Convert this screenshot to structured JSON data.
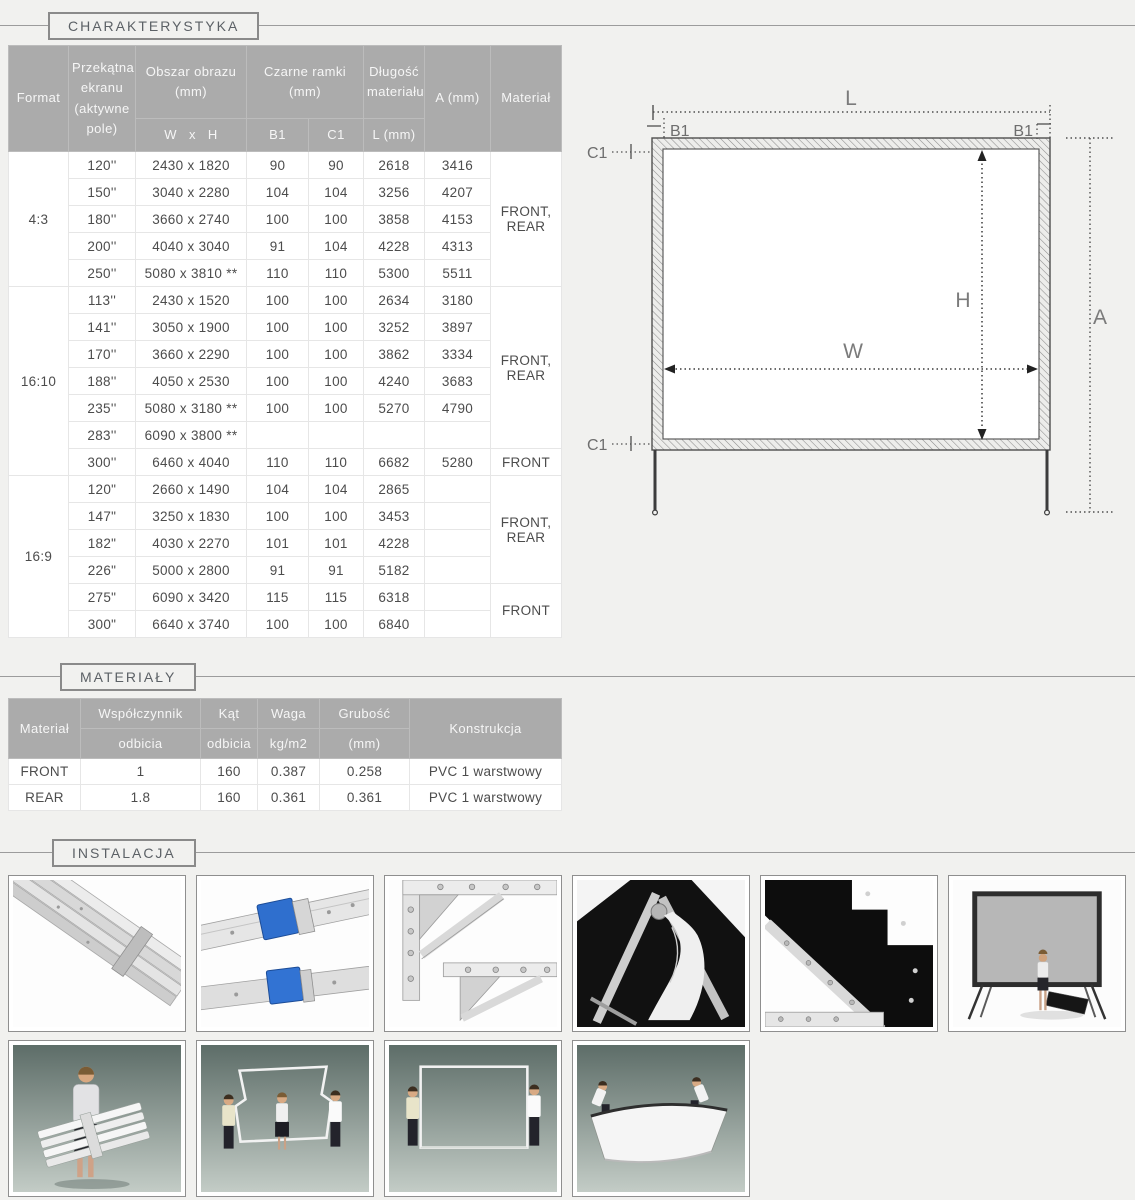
{
  "sections": {
    "charakterystyka": {
      "label": "CHARAKTERYSTYKA"
    },
    "materialy": {
      "label": "MATERIAŁY"
    },
    "instalacja": {
      "label": "INSTALACJA"
    }
  },
  "spec_table": {
    "headers": {
      "format": "Format",
      "diagonal": "Przekątna ekranu (aktywne pole)",
      "image_area": "Obszar obrazu (mm)",
      "image_area_sub": "W   x   H",
      "black_frames": "Czarne ramki (mm)",
      "b1": "B1",
      "c1": "C1",
      "length": "Długość materiału",
      "length_sub": "L (mm)",
      "a": "A (mm)",
      "material": "Materiał"
    },
    "groups": [
      {
        "format": "4:3",
        "rows": [
          {
            "d": "120''",
            "wh": "2430 x 1820",
            "b1": "90",
            "c1": "90",
            "l": "2618",
            "a": "3416"
          },
          {
            "d": "150''",
            "wh": "3040 x 2280",
            "b1": "104",
            "c1": "104",
            "l": "3256",
            "a": "4207"
          },
          {
            "d": "180''",
            "wh": "3660 x 2740",
            "b1": "100",
            "c1": "100",
            "l": "3858",
            "a": "4153"
          },
          {
            "d": "200''",
            "wh": "4040 x 3040",
            "b1": "91",
            "c1": "104",
            "l": "4228",
            "a": "4313"
          },
          {
            "d": "250''",
            "wh": "5080 x 3810 **",
            "b1": "110",
            "c1": "110",
            "l": "5300",
            "a": "5511"
          }
        ],
        "materials": [
          {
            "label": "FRONT, REAR"
          }
        ]
      },
      {
        "format": "16:10",
        "rows": [
          {
            "d": "113''",
            "wh": "2430 x 1520",
            "b1": "100",
            "c1": "100",
            "l": "2634",
            "a": "3180"
          },
          {
            "d": "141''",
            "wh": "3050 x 1900",
            "b1": "100",
            "c1": "100",
            "l": "3252",
            "a": "3897"
          },
          {
            "d": "170''",
            "wh": "3660 x 2290",
            "b1": "100",
            "c1": "100",
            "l": "3862",
            "a": "3334"
          },
          {
            "d": "188''",
            "wh": "4050 x 2530",
            "b1": "100",
            "c1": "100",
            "l": "4240",
            "a": "3683"
          },
          {
            "d": "235''",
            "wh": "5080 x 3180 **",
            "b1": "100",
            "c1": "100",
            "l": "5270",
            "a": "4790"
          },
          {
            "d": "283''",
            "wh": "6090 x 3800 **",
            "b1": "",
            "c1": "",
            "l": "",
            "a": ""
          },
          {
            "d": "300''",
            "wh": "6460 x 4040",
            "b1": "110",
            "c1": "110",
            "l": "6682",
            "a": "5280"
          }
        ],
        "materials": [
          {
            "label": "FRONT, REAR"
          },
          {
            "label": "FRONT"
          }
        ]
      },
      {
        "format": "16:9",
        "rows": [
          {
            "d": "120\"",
            "wh": "2660 x 1490",
            "b1": "104",
            "c1": "104",
            "l": "2865",
            "a": ""
          },
          {
            "d": "147\"",
            "wh": "3250 x 1830",
            "b1": "100",
            "c1": "100",
            "l": "3453",
            "a": ""
          },
          {
            "d": "182\"",
            "wh": "4030 x 2270",
            "b1": "101",
            "c1": "101",
            "l": "4228",
            "a": ""
          },
          {
            "d": "226\"",
            "wh": "5000 x 2800",
            "b1": "91",
            "c1": "91",
            "l": "5182",
            "a": ""
          },
          {
            "d": "275\"",
            "wh": "6090 x 3420",
            "b1": "115",
            "c1": "115",
            "l": "6318",
            "a": ""
          },
          {
            "d": "300\"",
            "wh": "6640 x 3740",
            "b1": "100",
            "c1": "100",
            "l": "6840",
            "a": ""
          }
        ],
        "materials": [
          {
            "label": "FRONT, REAR"
          },
          {
            "label": "FRONT"
          }
        ]
      }
    ]
  },
  "materials_table": {
    "headers": {
      "material": "Materiał",
      "reflection_top": "Współczynnik",
      "reflection_bottom": "odbicia",
      "angle_top": "Kąt",
      "angle_bottom": "odbicia",
      "weight_top": "Waga",
      "weight_bottom": "kg/m2",
      "thickness_top": "Grubość",
      "thickness_bottom": "(mm)",
      "construction": "Konstrukcja"
    },
    "rows": [
      {
        "material": "FRONT",
        "reflection": "1",
        "angle": "160",
        "weight": "0.387",
        "thickness": "0.258",
        "construction": "PVC 1 warstwowy"
      },
      {
        "material": "REAR",
        "reflection": "1.8",
        "angle": "160",
        "weight": "0.361",
        "thickness": "0.361",
        "construction": "PVC 1 warstwowy"
      }
    ]
  },
  "diagram": {
    "labels": {
      "l": "L",
      "b1_left": "B1",
      "b1_right": "B1",
      "c1_top": "C1",
      "c1_bottom": "C1",
      "h": "H",
      "w": "W",
      "a": "A"
    }
  },
  "gallery": {
    "row1": [
      {
        "name": "folded-frame-beams-photo"
      },
      {
        "name": "frame-hinge-blue-clamps-photo"
      },
      {
        "name": "frame-corner-braces-photo"
      },
      {
        "name": "transport-case-screen-fabric-photo"
      },
      {
        "name": "screen-corner-bracket-photo"
      },
      {
        "name": "assembled-screen-with-presenter-photo"
      }
    ],
    "row2": [
      {
        "name": "person-carrying-folded-frame-photo"
      },
      {
        "name": "three-people-unfolding-frame-photo"
      },
      {
        "name": "two-people-holding-frame-photo"
      },
      {
        "name": "two-people-stretching-fabric-photo"
      }
    ]
  },
  "colors": {
    "page_background": "#f1f1ef",
    "table_header_gray": "#ababab",
    "clamp_blue": "#2f6fce",
    "diagram_line": "#555555"
  }
}
